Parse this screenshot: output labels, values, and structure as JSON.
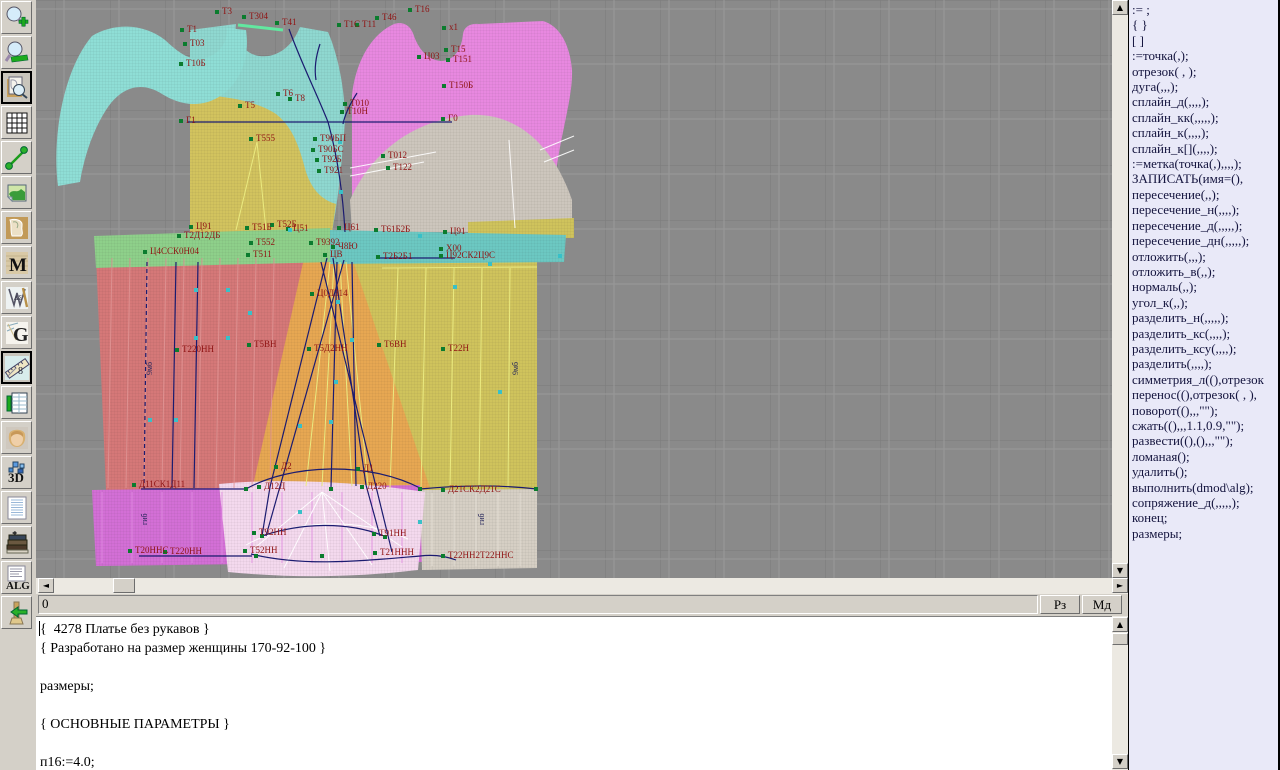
{
  "app": {
    "canvas_bg": "#8a8a8a",
    "grid_dark": "#7b7b7b",
    "grid_light": "#999999",
    "label_color": "#8f1212",
    "line_color": "#1b1b70",
    "panel_bg": "#e9e9f8"
  },
  "toolbar": {
    "items": [
      {
        "name": "zoom-in",
        "pressed": false
      },
      {
        "name": "zoom-out",
        "pressed": false
      },
      {
        "name": "preview",
        "pressed": true
      },
      {
        "name": "grid",
        "pressed": false
      },
      {
        "name": "segment",
        "pressed": false
      },
      {
        "name": "image",
        "pressed": false
      },
      {
        "name": "pattern-piece",
        "pressed": false
      },
      {
        "name": "fabric-m",
        "pressed": false
      },
      {
        "name": "drafting-tools",
        "pressed": false
      },
      {
        "name": "g-logo",
        "pressed": false
      },
      {
        "name": "measure",
        "pressed": true
      },
      {
        "name": "table",
        "pressed": false
      },
      {
        "name": "portrait",
        "pressed": false
      },
      {
        "name": "three-d",
        "pressed": false
      },
      {
        "name": "list-doc",
        "pressed": false
      },
      {
        "name": "books",
        "pressed": false
      },
      {
        "name": "alg-doc",
        "pressed": false
      },
      {
        "name": "exit-broom",
        "pressed": false
      }
    ]
  },
  "statusbar": {
    "value": "0",
    "buttons": [
      {
        "name": "rz-button",
        "label": "Рз"
      },
      {
        "name": "md-button",
        "label": "Мд"
      }
    ]
  },
  "editor": {
    "lines": [
      "{  4278 Платье без рукавов }",
      "{ Разработано на размер женщины 170-92-100 }",
      "",
      "размеры;",
      "",
      "{ ОСНОВНЫЕ ПАРАМЕТРЫ }",
      "",
      "п16:=4.0;"
    ]
  },
  "commands": {
    "items": [
      ":= ;",
      "{ }",
      "[ ]",
      ":=точка(,);",
      "отрезок( , );",
      "дуга(,,,);",
      "сплайн_д(,,,,);",
      "сплайн_кк(,,,,,);",
      "сплайн_к(,,,,);",
      "сплайн_к[](,,,,);",
      ":=метка(точка(,),,,,);",
      "ЗАПИСАТЬ(имя=(),",
      "пересечение(,,);",
      "пересечение_н(,,,,);",
      "пересечение_д(,,,,,);",
      "пересечение_дн(,,,,,);",
      "отложить(,,,);",
      "отложить_в(,,);",
      "нормаль(,,);",
      "угол_к(,,);",
      "разделить_н(,,,,,);",
      "разделить_кс(,,,,);",
      "разделить_ксу(,,,,);",
      "разделить(,,,,);",
      "симметрия_л((),отрезок",
      "перенос((),отрезок( , ),",
      "поворот((),,,\"\");",
      "сжать((),,,1.1,0.9,\"\");",
      "развести((),(),,,\"\");",
      "ломаная();",
      "удалить();",
      "выполнить(dmod\\alg);",
      "сопряжение_д(,,,,,);",
      "конец;",
      "размеры;"
    ]
  },
  "drawing": {
    "pieces": [
      {
        "name": "bodice-front-upper",
        "fill": "#8fd8d0",
        "d": "M190,30 L236,24 C234,36 240,48 252,54 C270,61 290,52 300,27 L328,32 C338,55 345,90 345,120 C342,162 338,202 332,232 L190,232 Z"
      },
      {
        "name": "bodice-front-lower",
        "fill": "#d2c35e",
        "d": "M190,94 C230,96 258,102 276,114 C294,128 300,150 306,172 C312,190 322,200 336,204 L332,232 L190,232 Z"
      },
      {
        "name": "sleeve-cap",
        "fill": "#8fded6",
        "d": "M92,36 C115,22 145,24 165,40 C178,52 190,62 205,58 C220,54 228,42 227,28 L246,30 C250,55 242,80 222,95 C200,110 178,104 162,94 C140,80 120,88 106,110 C92,132 84,158 80,182 L58,186 C52,140 62,72 92,36 Z"
      },
      {
        "name": "bodice-back",
        "fill": "#e888e0",
        "d": "M352,95 C356,60 372,34 394,24 C404,21 411,26 414,36 C419,50 428,60 441,61 C455,61 462,47 463,34 C464,27 470,23 479,24 L543,21 C560,26 570,45 572,70 C573,95 562,130 557,165 C554,195 561,215 571,232 L352,232 Z"
      },
      {
        "name": "bodice-back-lower",
        "fill": "#cdc6bd",
        "d": "M352,232 L350,200 C370,155 410,120 470,115 C520,112 555,150 572,200 L572,232 Z"
      },
      {
        "name": "skirt-left",
        "fill": "#d57878",
        "d": "M96,256 L310,251 L300,360 L296,490 L106,490 Z"
      },
      {
        "name": "skirt-right",
        "fill": "#cfc35c",
        "d": "M346,250 L537,246 L537,490 L300,490 Z"
      },
      {
        "name": "skirt-center",
        "fill": "#e7a752",
        "d": "M305,254 L350,252 L430,488 L252,490 Z"
      },
      {
        "name": "khaki-top-strip",
        "fill": "#cfc35c",
        "d": "M468,222 L574,218 L574,238 L468,238 Z"
      },
      {
        "name": "waistband-left",
        "fill": "#8ed08a",
        "d": "M94,236 L330,228 L332,262 L96,268 Z"
      },
      {
        "name": "waistband-right",
        "fill": "#6cc8c2",
        "d": "M330,230 L566,235 L564,262 L330,264 Z"
      },
      {
        "name": "hem-band-left",
        "fill": "#d36fd6",
        "d": "M92,490 L420,485 L422,562 L96,566 Z"
      },
      {
        "name": "hem-band-right",
        "fill": "#d6cfc4",
        "d": "M420,490 L537,489 L537,568 L422,570 Z"
      },
      {
        "name": "hem-overlay",
        "fill": "#f4d9ee",
        "d": "M219,484 C280,478 360,482 425,492 L418,570 C350,578 290,578 228,572 Z"
      }
    ],
    "stripes": [
      {
        "x0": 112,
        "n": 10,
        "dx": 18,
        "y1": 258,
        "y2": 488,
        "skew": -4,
        "c": "#e09595"
      },
      {
        "x0": 102,
        "n": 11,
        "dx": 30,
        "y1": 492,
        "y2": 563,
        "skew": 0,
        "c": "#e08ae0"
      },
      {
        "x0": 432,
        "n": 5,
        "dx": 22,
        "y1": 493,
        "y2": 566,
        "skew": 0,
        "c": "#e6e0d6"
      }
    ],
    "yellow_lines": [
      "M257,142 L236,230",
      "M257,142 L266,230",
      "M330,262 L306,486",
      "M334,262 L322,486",
      "M340,262 L352,486",
      "M346,262 L368,486",
      "M398,268 L390,488",
      "M426,268 L421,488",
      "M454,268 L450,488",
      "M482,268 L479,488",
      "M510,268 L508,488",
      "M382,268 L537,267"
    ],
    "white_lines": [
      "M350,168 L436,152",
      "M350,176 L424,162",
      "M540,150 L574,136",
      "M544,162 L574,150",
      "M509,140 L515,228",
      "M322,492 L252,550",
      "M322,492 L284,568",
      "M322,492 L330,571",
      "M322,492 L372,565",
      "M322,492 L402,547",
      "M246,545 C292,519 360,517 408,539"
    ],
    "navy_lines": [
      {
        "d": "M188,122 L452,122"
      },
      {
        "d": "M289,29 C300,60 316,92 328,122 C338,158 343,196 345,232"
      },
      {
        "d": "M357,93 C350,104 345,114 343,124"
      },
      {
        "d": "M320,44 C316,56 314,68 316,80"
      },
      {
        "d": "M327,258 L270,487"
      },
      {
        "d": "M333,258 L366,485"
      },
      {
        "d": "M321,262 L392,552"
      },
      {
        "d": "M344,260 L266,536"
      },
      {
        "d": "M337,262 L331,488"
      },
      {
        "d": "M352,262 L356,486"
      },
      {
        "d": "M246,489 C290,464 368,461 420,488"
      },
      {
        "d": "M262,536 C300,523 347,521 384,536"
      },
      {
        "d": "M251,554 C305,567 360,561 420,556 C436,554 448,557 456,560"
      },
      {
        "d": "M141,489 L248,489"
      },
      {
        "d": "M139,556 L252,556"
      },
      {
        "d": "M380,258 L455,258"
      },
      {
        "d": "M420,489 C462,485 502,485 537,489"
      },
      {
        "d": "M147,262 L144,488",
        "dash": "4,3"
      },
      {
        "d": "M176,262 L172,488"
      },
      {
        "d": "M198,262 L194,488"
      },
      {
        "d": "M270,487 L262,536"
      },
      {
        "d": "M366,485 L380,536"
      }
    ],
    "green_strips": [
      "M238,25 L283,30"
    ],
    "labels": [
      {
        "t": "Т3",
        "x": 222,
        "y": 14
      },
      {
        "t": "Т304",
        "x": 249,
        "y": 19
      },
      {
        "t": "Т41",
        "x": 282,
        "y": 25
      },
      {
        "t": "Т1",
        "x": 187,
        "y": 32
      },
      {
        "t": "Т03",
        "x": 190,
        "y": 46
      },
      {
        "t": "Т10Б",
        "x": 186,
        "y": 66
      },
      {
        "t": "Т5",
        "x": 245,
        "y": 108
      },
      {
        "t": "Т6",
        "x": 283,
        "y": 96
      },
      {
        "t": "Т8",
        "x": 295,
        "y": 101
      },
      {
        "t": "Г1",
        "x": 186,
        "y": 123
      },
      {
        "t": "Т555",
        "x": 256,
        "y": 141
      },
      {
        "t": "Т90БП",
        "x": 320,
        "y": 141
      },
      {
        "t": "Т90БС",
        "x": 318,
        "y": 152
      },
      {
        "t": "Т92Б",
        "x": 322,
        "y": 162
      },
      {
        "t": "Т921",
        "x": 324,
        "y": 173
      },
      {
        "t": "Т16",
        "x": 415,
        "y": 12
      },
      {
        "t": "Т46",
        "x": 382,
        "y": 20
      },
      {
        "t": "Т1С",
        "x": 344,
        "y": 27
      },
      {
        "t": "Т11",
        "x": 362,
        "y": 27
      },
      {
        "t": "х1",
        "x": 449,
        "y": 30
      },
      {
        "t": "Т15",
        "x": 451,
        "y": 52
      },
      {
        "t": "Т151",
        "x": 453,
        "y": 62
      },
      {
        "t": "Ц03",
        "x": 424,
        "y": 59
      },
      {
        "t": "Т150Б",
        "x": 449,
        "y": 88
      },
      {
        "t": "Т010",
        "x": 350,
        "y": 106
      },
      {
        "t": "Т10Н",
        "x": 347,
        "y": 114
      },
      {
        "t": "Г0",
        "x": 448,
        "y": 121
      },
      {
        "t": "Т012",
        "x": 388,
        "y": 158
      },
      {
        "t": "Т122",
        "x": 393,
        "y": 170
      },
      {
        "t": "Ц91",
        "x": 196,
        "y": 229
      },
      {
        "t": "Т2Д12ДБ",
        "x": 184,
        "y": 238
      },
      {
        "t": "Т51Б",
        "x": 252,
        "y": 230
      },
      {
        "t": "Т52Б",
        "x": 277,
        "y": 227
      },
      {
        "t": "Ц51",
        "x": 293,
        "y": 231
      },
      {
        "t": "Ц61",
        "x": 344,
        "y": 230
      },
      {
        "t": "Т552",
        "x": 256,
        "y": 245
      },
      {
        "t": "Ц4ССК0Н04",
        "x": 150,
        "y": 254
      },
      {
        "t": "Т511",
        "x": 253,
        "y": 257
      },
      {
        "t": "Т9392",
        "x": 316,
        "y": 245
      },
      {
        "t": "Ч8Ю",
        "x": 338,
        "y": 249
      },
      {
        "t": "ЦВ",
        "x": 330,
        "y": 257
      },
      {
        "t": "Т61Б2Б",
        "x": 381,
        "y": 232
      },
      {
        "t": "Ц91",
        "x": 450,
        "y": 234
      },
      {
        "t": "Х00",
        "x": 446,
        "y": 251
      },
      {
        "t": "Ц92СК2Ц9С",
        "x": 446,
        "y": 258
      },
      {
        "t": "Т2Б2Б1",
        "x": 383,
        "y": 259
      },
      {
        "t": "Ц0Д314",
        "x": 317,
        "y": 296
      },
      {
        "t": "Т220НН",
        "x": 182,
        "y": 352
      },
      {
        "t": "Т5ВН",
        "x": 254,
        "y": 347
      },
      {
        "t": "Т5Д2НН",
        "x": 314,
        "y": 351
      },
      {
        "t": "Т6ВН",
        "x": 384,
        "y": 347
      },
      {
        "t": "Т22Н",
        "x": 448,
        "y": 351
      },
      {
        "t": "Д2",
        "x": 281,
        "y": 469
      },
      {
        "t": "Д1",
        "x": 363,
        "y": 471
      },
      {
        "t": "Д11СК1Д11",
        "x": 139,
        "y": 487
      },
      {
        "t": "Д12Д",
        "x": 264,
        "y": 489
      },
      {
        "t": "Д220",
        "x": 367,
        "y": 489
      },
      {
        "t": "Д21СК2Д21С",
        "x": 448,
        "y": 492
      },
      {
        "t": "Т92НН",
        "x": 259,
        "y": 535
      },
      {
        "t": "Т91НН",
        "x": 379,
        "y": 536
      },
      {
        "t": "Т20ННС",
        "x": 135,
        "y": 553
      },
      {
        "t": "Т220НН",
        "x": 170,
        "y": 554
      },
      {
        "t": "Т52НН",
        "x": 250,
        "y": 553
      },
      {
        "t": "Т21ННН",
        "x": 380,
        "y": 555
      },
      {
        "t": "Т22НН2Т22ННС",
        "x": 448,
        "y": 558
      }
    ],
    "vlabels": [
      {
        "t": "9мб",
        "x": 152,
        "y": 375
      },
      {
        "t": "9мб",
        "x": 518,
        "y": 375
      },
      {
        "t": "гиб",
        "x": 147,
        "y": 525
      },
      {
        "t": "гиб",
        "x": 484,
        "y": 525
      }
    ],
    "markers": [
      {
        "x": 196,
        "y": 290
      },
      {
        "x": 196,
        "y": 338
      },
      {
        "x": 228,
        "y": 290
      },
      {
        "x": 228,
        "y": 338
      },
      {
        "x": 150,
        "y": 420
      },
      {
        "x": 176,
        "y": 420
      },
      {
        "x": 250,
        "y": 313
      },
      {
        "x": 338,
        "y": 302
      },
      {
        "x": 352,
        "y": 340
      },
      {
        "x": 300,
        "y": 426
      },
      {
        "x": 336,
        "y": 382
      },
      {
        "x": 331,
        "y": 422
      },
      {
        "x": 420,
        "y": 522
      },
      {
        "x": 300,
        "y": 512
      },
      {
        "x": 455,
        "y": 287
      },
      {
        "x": 500,
        "y": 392
      },
      {
        "x": 560,
        "y": 256
      },
      {
        "x": 340,
        "y": 142
      },
      {
        "x": 341,
        "y": 192
      },
      {
        "x": 290,
        "y": 230
      },
      {
        "x": 420,
        "y": 236
      },
      {
        "x": 490,
        "y": 264
      },
      {
        "x": 246,
        "y": 489,
        "c": "#0b7c2e"
      },
      {
        "x": 420,
        "y": 489,
        "c": "#0b7c2e"
      },
      {
        "x": 331,
        "y": 489,
        "c": "#0b7c2e"
      },
      {
        "x": 536,
        "y": 489,
        "c": "#0b7c2e"
      },
      {
        "x": 256,
        "y": 556,
        "c": "#0b7c2e"
      },
      {
        "x": 322,
        "y": 556,
        "c": "#0b7c2e"
      },
      {
        "x": 385,
        "y": 537,
        "c": "#0b7c2e"
      },
      {
        "x": 262,
        "y": 536,
        "c": "#0b7c2e"
      }
    ]
  }
}
